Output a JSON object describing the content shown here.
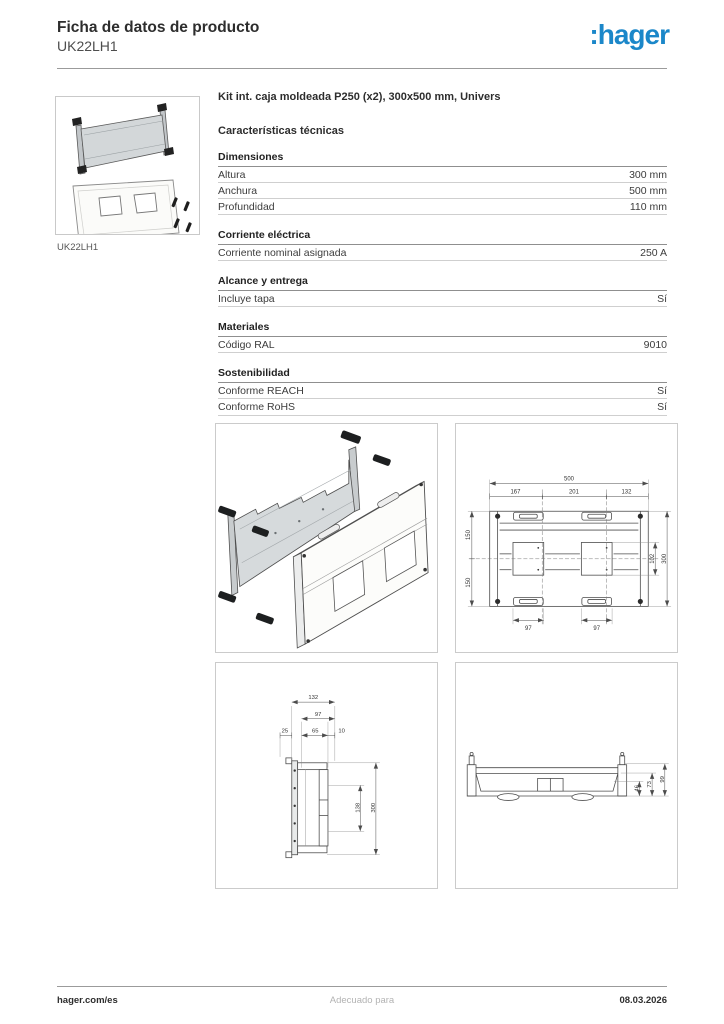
{
  "header": {
    "title": "Ficha de datos de producto",
    "product_code": "UK22LH1",
    "logo_text": ":hager",
    "logo_color": "#1b87c9"
  },
  "product": {
    "thumbnail_caption": "UK22LH1",
    "description": "Kit int. caja moldeada P250 (x2), 300x500 mm, Univers"
  },
  "tech": {
    "heading": "Características técnicas",
    "sections": [
      {
        "title": "Dimensiones",
        "rows": [
          {
            "label": "Altura",
            "value": "300 mm"
          },
          {
            "label": "Anchura",
            "value": "500 mm"
          },
          {
            "label": "Profundidad",
            "value": "110 mm"
          }
        ]
      },
      {
        "title": "Corriente eléctrica",
        "rows": [
          {
            "label": "Corriente nominal asignada",
            "value": "250 A"
          }
        ]
      },
      {
        "title": "Alcance y entrega",
        "rows": [
          {
            "label": "Incluye tapa",
            "value": "Sí"
          }
        ]
      },
      {
        "title": "Materiales",
        "rows": [
          {
            "label": "Código RAL",
            "value": "9010"
          }
        ]
      },
      {
        "title": "Sostenibilidad",
        "rows": [
          {
            "label": "Conforme REACH",
            "value": "Sí"
          },
          {
            "label": "Conforme RoHS",
            "value": "Sí"
          }
        ]
      }
    ]
  },
  "illustrations": {
    "heading": "Ilustraciones e imágenes",
    "front_view": {
      "total_width": "500",
      "seg1": "167",
      "seg2": "201",
      "seg3": "132",
      "left_top": "150",
      "left_bottom": "150",
      "inner_height": "102",
      "total_height": "300",
      "slot_left": "97",
      "slot_right": "97"
    },
    "side_view": {
      "total_width": "132",
      "inner_width": "97",
      "offset_left": "25",
      "mid": "65",
      "offset_right": "10",
      "inner_height": "138",
      "total_height": "300"
    },
    "profile_view": {
      "depth1": "46",
      "depth2": "73",
      "depth3": "99"
    }
  },
  "footer": {
    "website": "hager.com/es",
    "center_text": "Adecuado para",
    "date": "08.03.2026"
  }
}
